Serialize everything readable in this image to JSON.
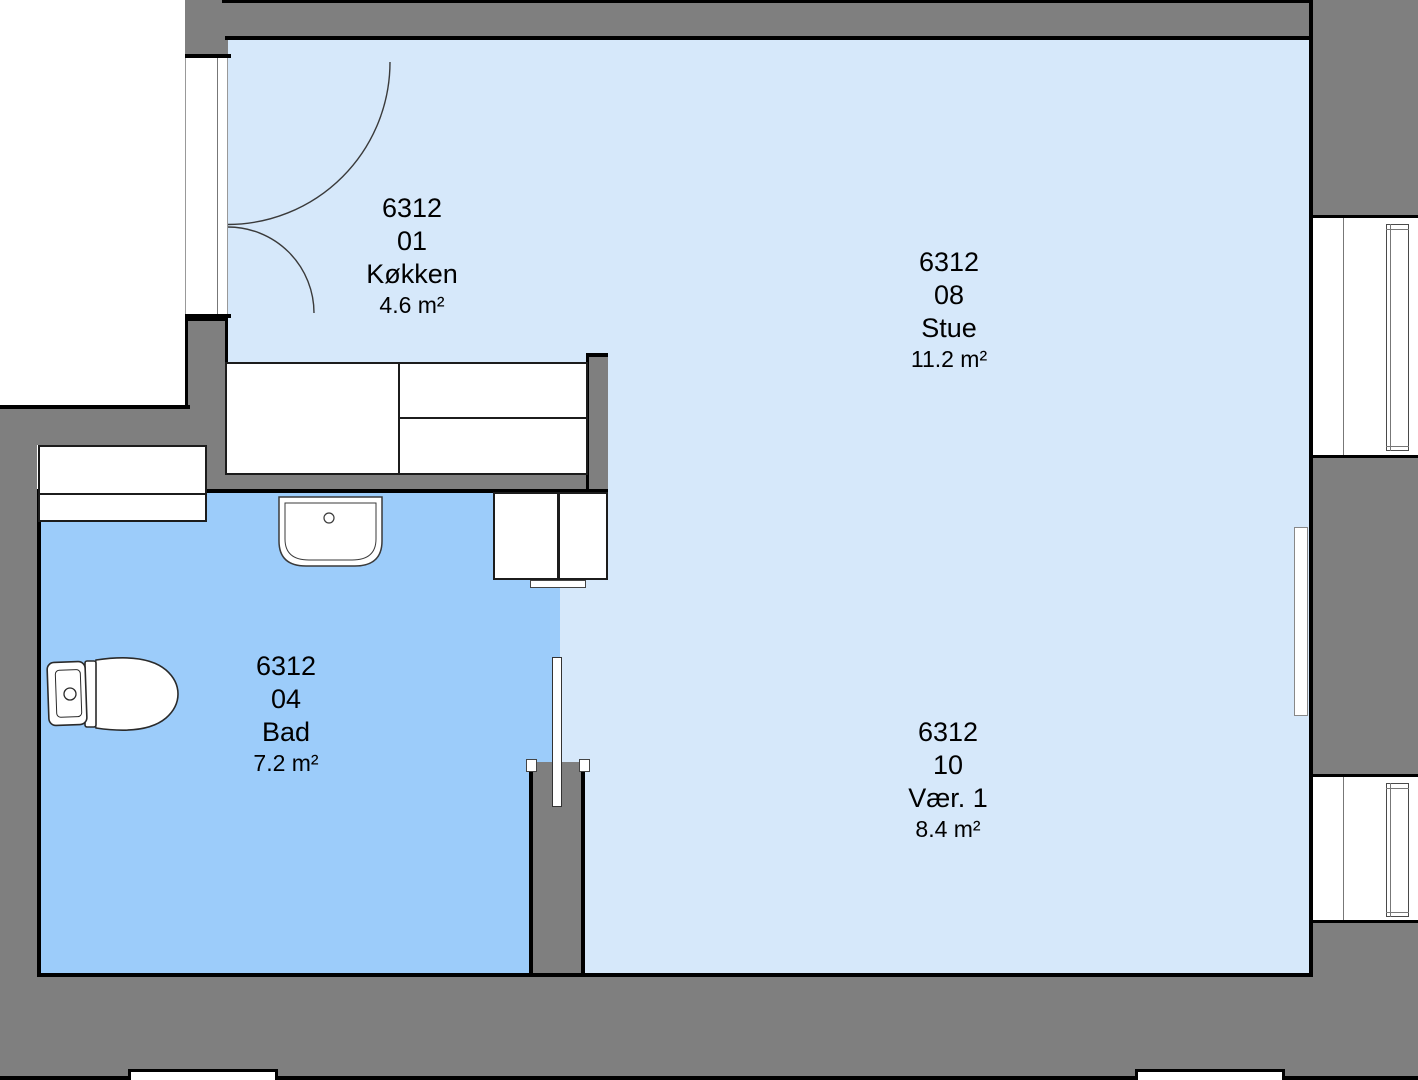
{
  "plan_title": "",
  "colors": {
    "wall": "#7f7f7f",
    "outline": "#000000",
    "room_light": "#d6e8fa",
    "room_dark": "#9cccfa",
    "fixture_fill": "#ffffff"
  },
  "rooms": [
    {
      "building": "6312",
      "number": "01",
      "name": "Køkken",
      "area": "4.6 m²"
    },
    {
      "building": "6312",
      "number": "08",
      "name": "Stue",
      "area": "11.2 m²"
    },
    {
      "building": "6312",
      "number": "04",
      "name": "Bad",
      "area": "7.2 m²"
    },
    {
      "building": "6312",
      "number": "10",
      "name": "Vær. 1",
      "area": "8.4 m²"
    }
  ],
  "fixtures": [
    "entrance-double-door-swing",
    "kitchen-counter",
    "bathroom-cabinet",
    "wardrobe-cabinet",
    "sink",
    "toilet",
    "radiator",
    "interior-door-leaf",
    "window",
    "window"
  ]
}
